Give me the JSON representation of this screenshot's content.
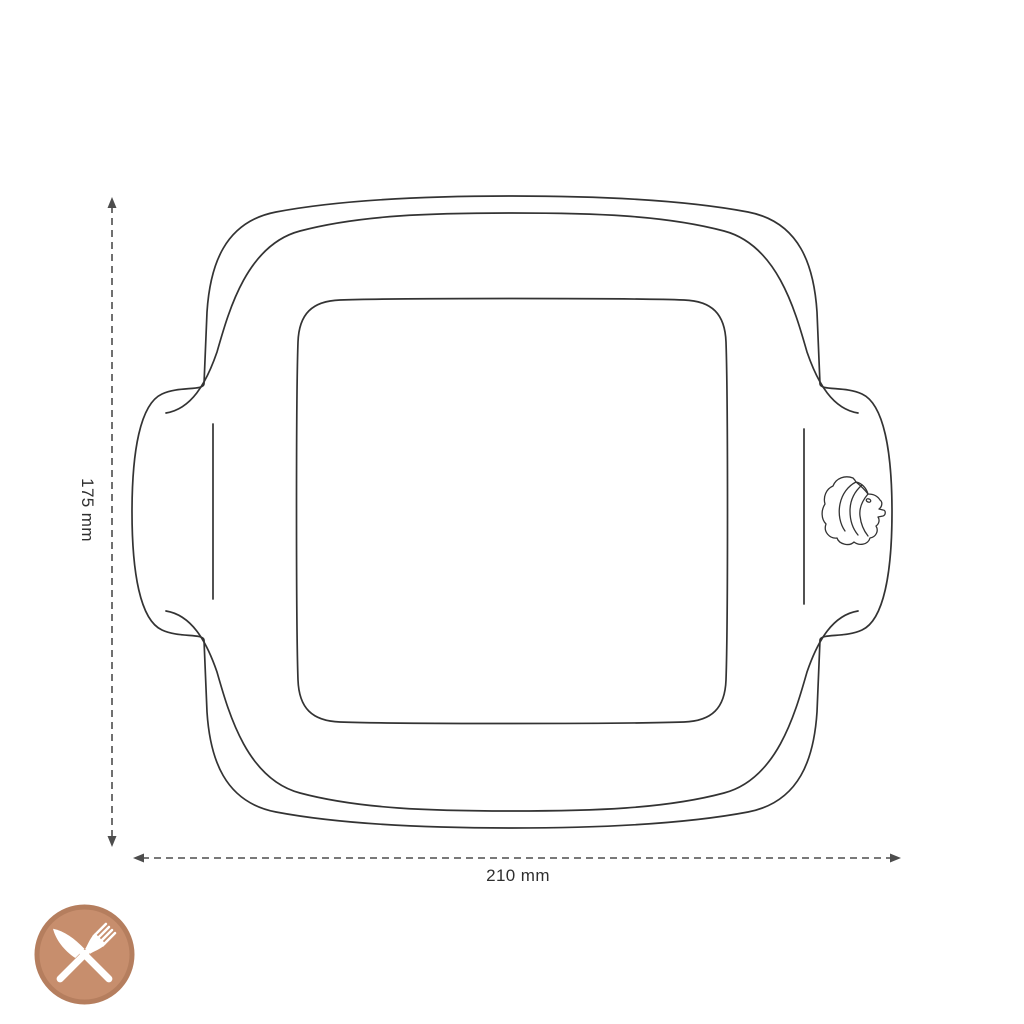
{
  "dimensions": {
    "height": {
      "label": "175 mm",
      "orientation": "vertical"
    },
    "width": {
      "label": "210 mm",
      "orientation": "horizontal"
    }
  },
  "drawing": {
    "subject": "square baking dish with side handles, top view",
    "logo_icon": "lion-head-icon"
  },
  "badge": {
    "icon": "crossed-knife-and-fork-icon",
    "fill": "#c78e6d",
    "ring": "#b57e5e",
    "glyph": "#ffffff"
  },
  "colors": {
    "line": "#333333",
    "dimension": "#4d4d4d",
    "text": "#2f2f2f",
    "background": "#ffffff"
  }
}
